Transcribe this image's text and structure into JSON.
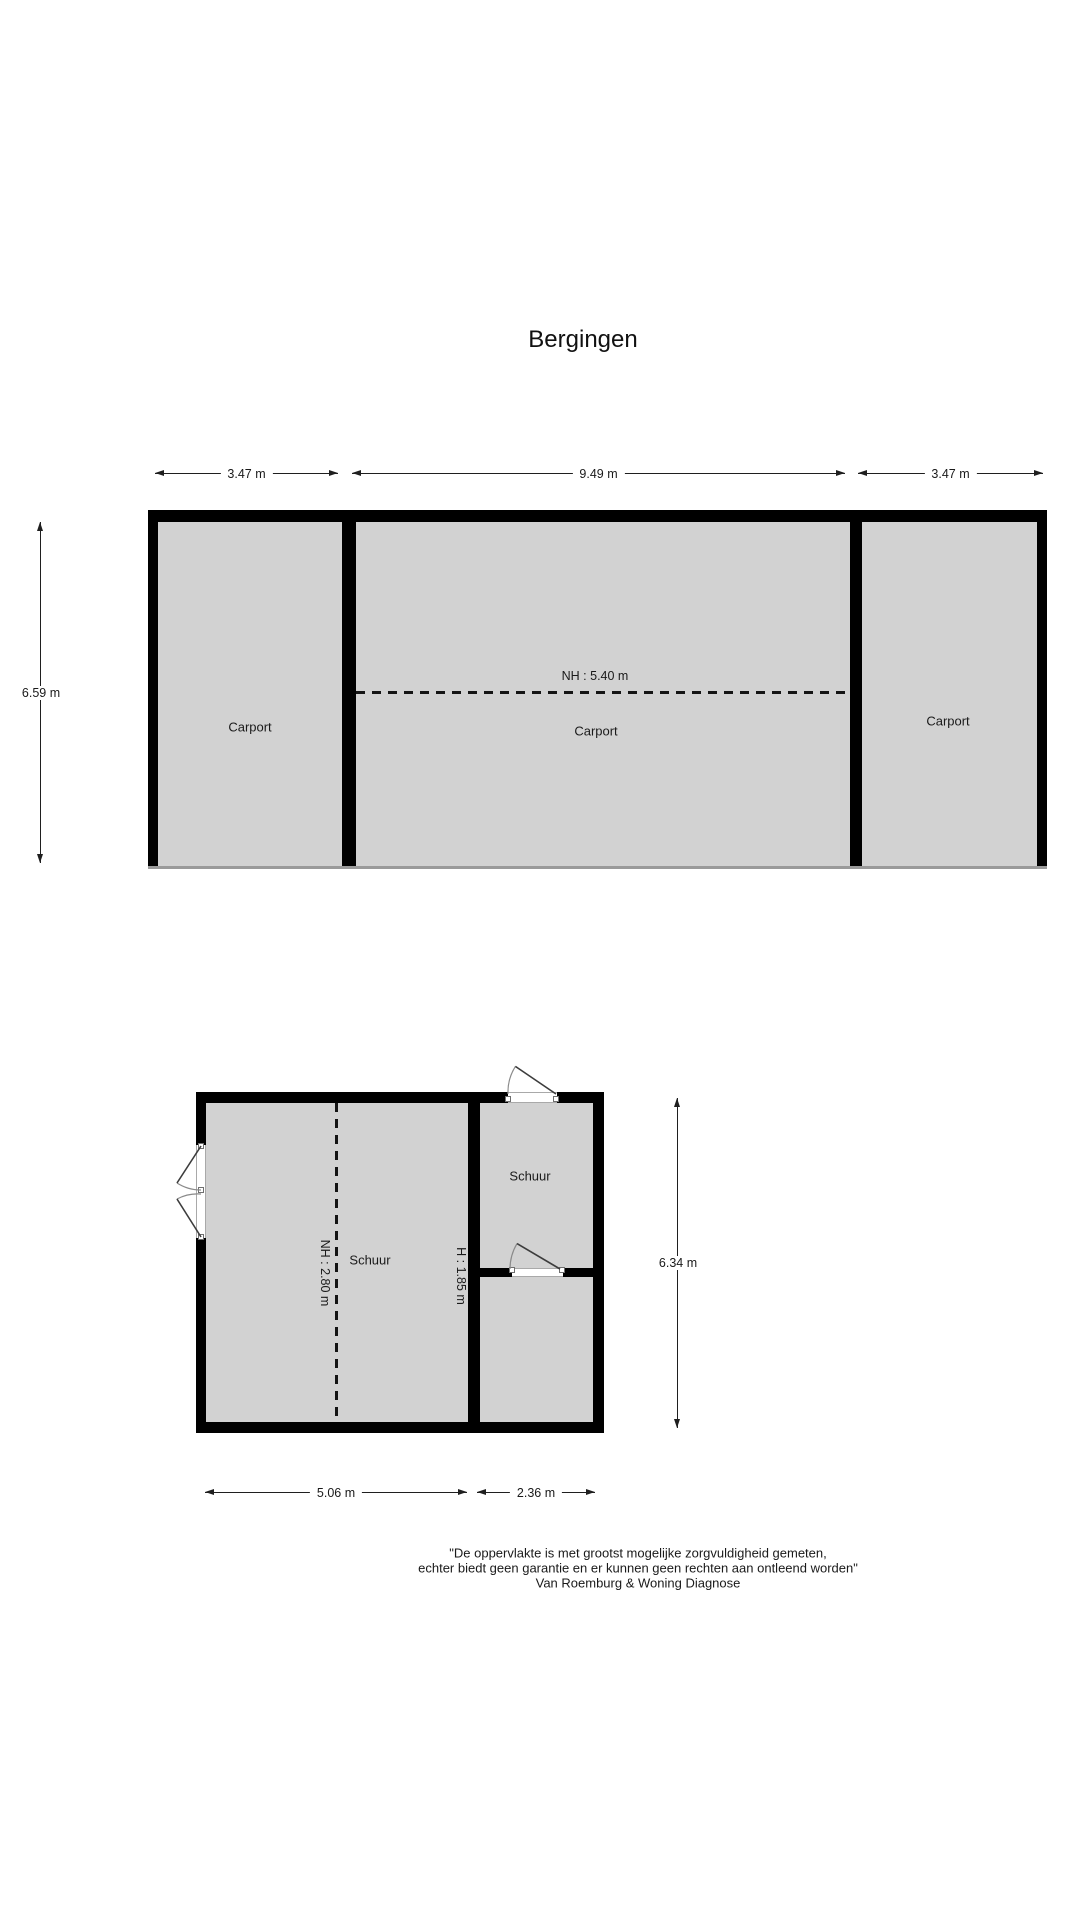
{
  "page_title": "Bergingen",
  "colors": {
    "room_fill": "#d2d2d2",
    "wall": "#000000",
    "background": "#ffffff"
  },
  "carport_building": {
    "dimensions": {
      "top_left": "3.47 m",
      "top_middle": "9.49 m",
      "top_right": "3.47 m",
      "left": "6.59 m"
    },
    "ceiling_height_label": "NH : 5.40 m",
    "rooms": [
      {
        "label": "Carport"
      },
      {
        "label": "Carport"
      },
      {
        "label": "Carport"
      }
    ]
  },
  "shed_building": {
    "dimensions": {
      "right": "6.34 m",
      "bottom_left": "5.06 m",
      "bottom_right": "2.36 m"
    },
    "ceiling_height_label": "NH : 2.80 m",
    "height_label": "H : 1.85 m",
    "rooms": [
      {
        "label": "Schuur"
      },
      {
        "label": "Schuur"
      }
    ]
  },
  "disclaimer": {
    "line1": "\"De oppervlakte is met grootst mogelijke zorgvuldigheid gemeten,",
    "line2": "echter biedt geen garantie en er kunnen geen rechten aan ontleend worden\"",
    "line3": "Van Roemburg & Woning Diagnose"
  }
}
